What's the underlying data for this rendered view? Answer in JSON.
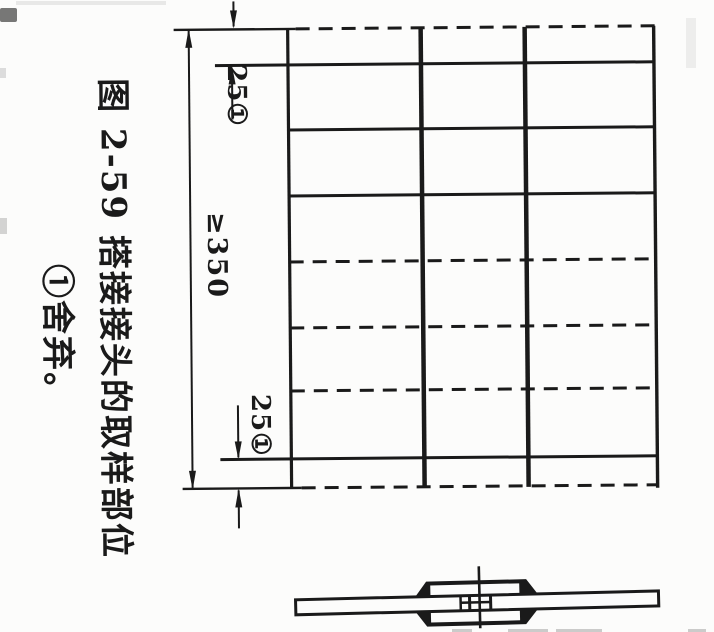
{
  "figure": {
    "caption_line1": "图 2-59 搭接接头的取样部位",
    "caption_line2": "①舍弃。",
    "labels": {
      "dim_top_margin": "25①",
      "dim_overall": "≥350",
      "dim_bottom_margin": "25①"
    },
    "colors": {
      "ink": "#1a1a1a",
      "paper": "#fcfcfb"
    }
  }
}
